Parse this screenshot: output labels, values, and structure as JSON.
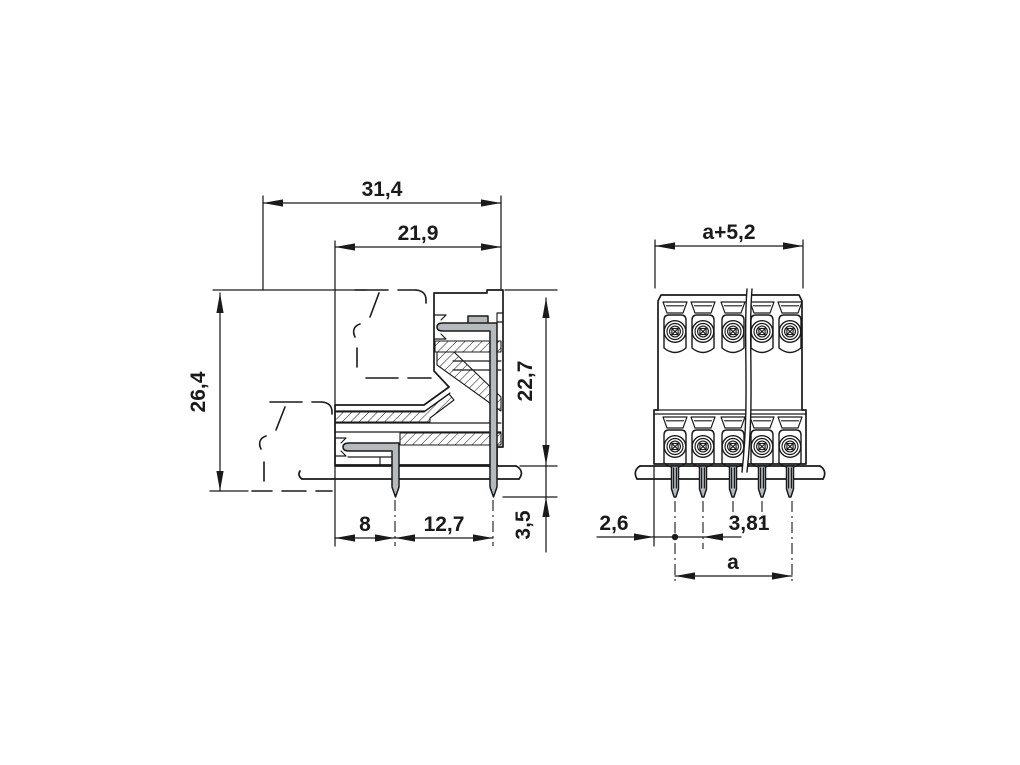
{
  "drawing": {
    "background_color": "#ffffff",
    "line_color": "#1a1a1a",
    "pin_fill_color": "#b6babd",
    "side_view": {
      "dims": {
        "overall_depth": "31,4",
        "header_depth": "21,9",
        "total_height": "26,4",
        "height_above_board": "22,7",
        "front_row_offset": "8",
        "row_spacing": "12,7",
        "pin_length": "3,5"
      }
    },
    "front_view": {
      "dims": {
        "overall_width": "a+5,2",
        "edge_to_first_pin": "2,6",
        "pitch": "3,81",
        "pin_span": "a"
      }
    }
  }
}
